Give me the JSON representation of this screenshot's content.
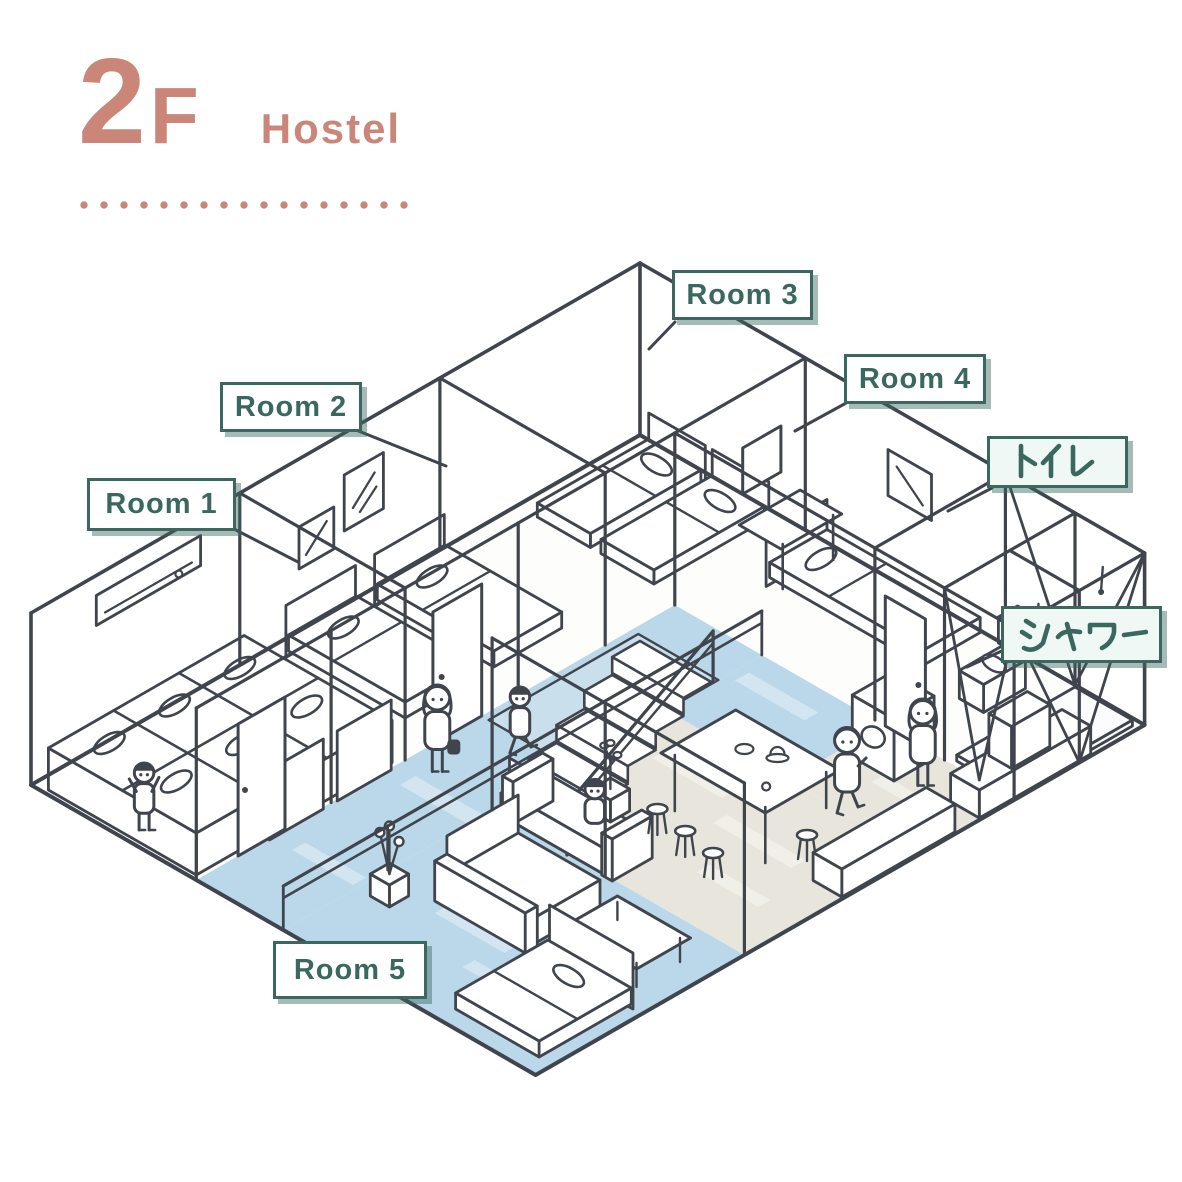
{
  "header": {
    "floor": "2",
    "floor_suffix": "F",
    "building_type": "Hostel"
  },
  "labels": {
    "room1": "Room 1",
    "room2": "Room 2",
    "room3": "Room 3",
    "room4": "Room 4",
    "room5": "Room 5",
    "toilet": "トイレ",
    "shower": "シャワー"
  },
  "colors": {
    "accent_salmon": "#ca8779",
    "teal": "#3a685f",
    "line": "#40454d",
    "floor_blue": "#bad8e9",
    "floor_beige": "#e8e6dc",
    "stair_well": "#c9dfec",
    "label_bg": "#ffffff",
    "label_bg_mint": "#f0f8f5",
    "label_shadow": "rgba(58,104,95,0.45)"
  }
}
